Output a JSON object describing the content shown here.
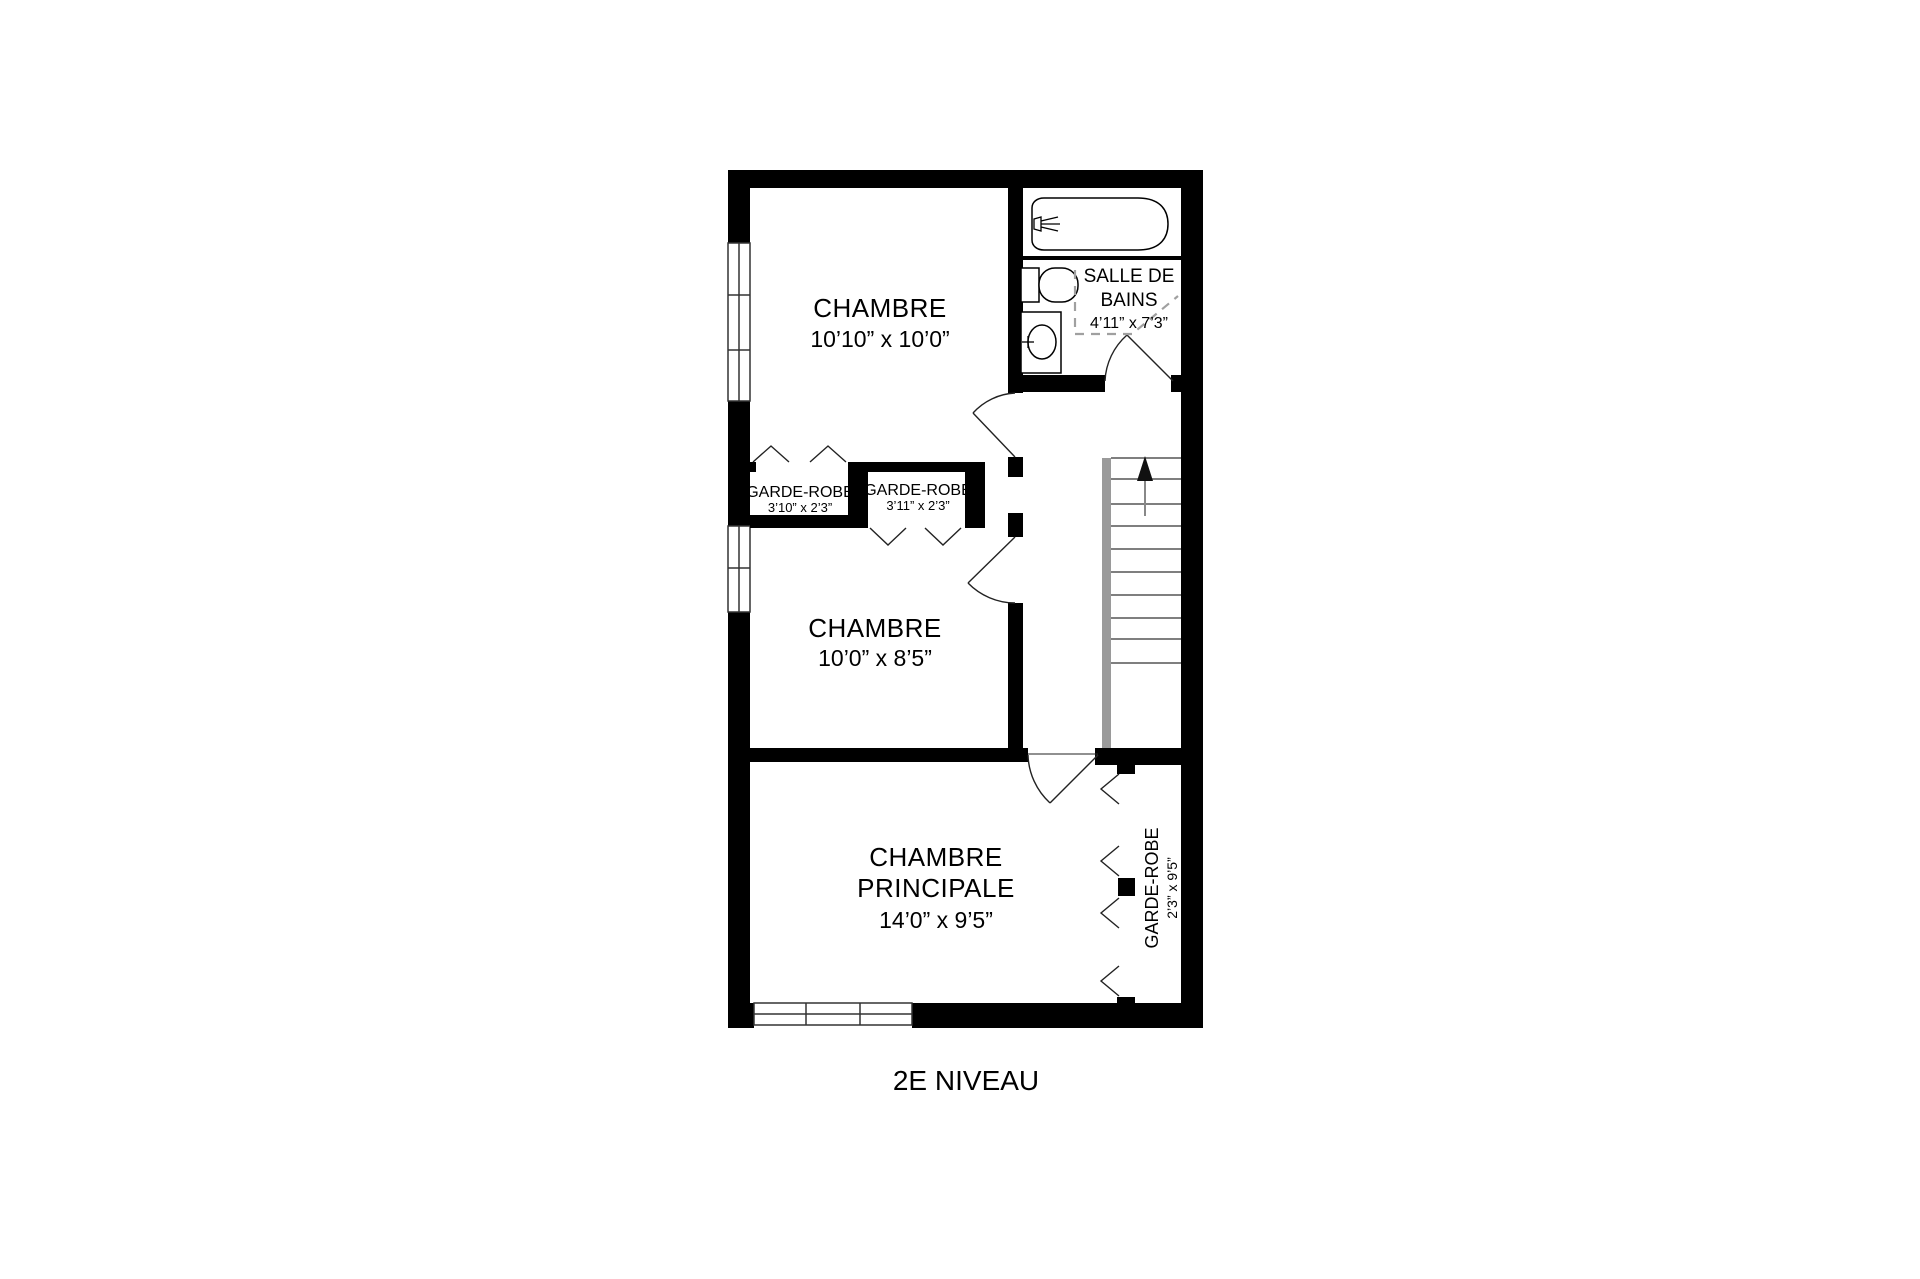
{
  "title": "2E NIVEAU",
  "rooms": {
    "bedroom1": {
      "name": "CHAMBRE",
      "dims": "10’10” x 10’0”"
    },
    "bedroom2": {
      "name": "CHAMBRE",
      "dims": "10’0” x 8’5”"
    },
    "master": {
      "name_line1": "CHAMBRE",
      "name_line2": "PRINCIPALE",
      "dims": "14’0” x 9’5”"
    },
    "bathroom": {
      "name_line1": "SALLE DE",
      "name_line2": "BAINS",
      "dims": "4’11” x 7’3”"
    },
    "closet1": {
      "name": "GARDE-ROBE",
      "dims": "3’10” x 2’3”"
    },
    "closet2": {
      "name": "GARDE-ROBE",
      "dims": "3’11” x 2’3”"
    },
    "closet_master": {
      "name": "GARDE-ROBE",
      "dims": "2’3” x 9’5”"
    }
  },
  "symbols": {
    "stairs_direction": "up-arrow"
  },
  "colors": {
    "wall": "#000000",
    "stair_stringer": "#9a9a9a",
    "dashed_ceiling": "#a0a0a0",
    "background": "#ffffff"
  }
}
